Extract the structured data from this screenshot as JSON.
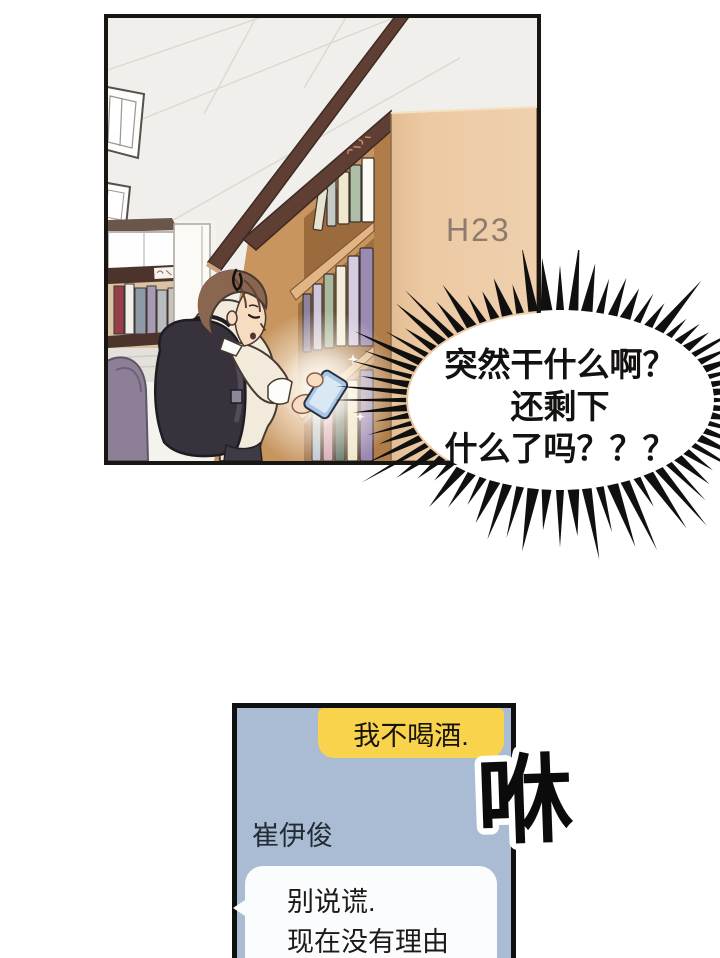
{
  "library_panel": {
    "shelf_sign": "H23"
  },
  "burst_bubble": {
    "lines": [
      "突然干什么啊？",
      "还剩下",
      "什么了吗？？？"
    ]
  },
  "sfx": {
    "whoosh": "咻"
  },
  "chat": {
    "outgoing_message": "我不喝酒.",
    "contact_name": "崔伊俊",
    "incoming_message_lines": [
      "别说谎.",
      "现在没有理由"
    ]
  },
  "colors": {
    "chat_panel_bg": "#a9bcd3",
    "outgoing_bubble_bg": "#f8d34b",
    "incoming_bubble_bg": "#fbfcfd",
    "panel_border": "#101010",
    "shelf_end_panel": "#ecc9a3",
    "shelf_sign_text": "#8d7b6d",
    "burst_spike": "#101010"
  }
}
